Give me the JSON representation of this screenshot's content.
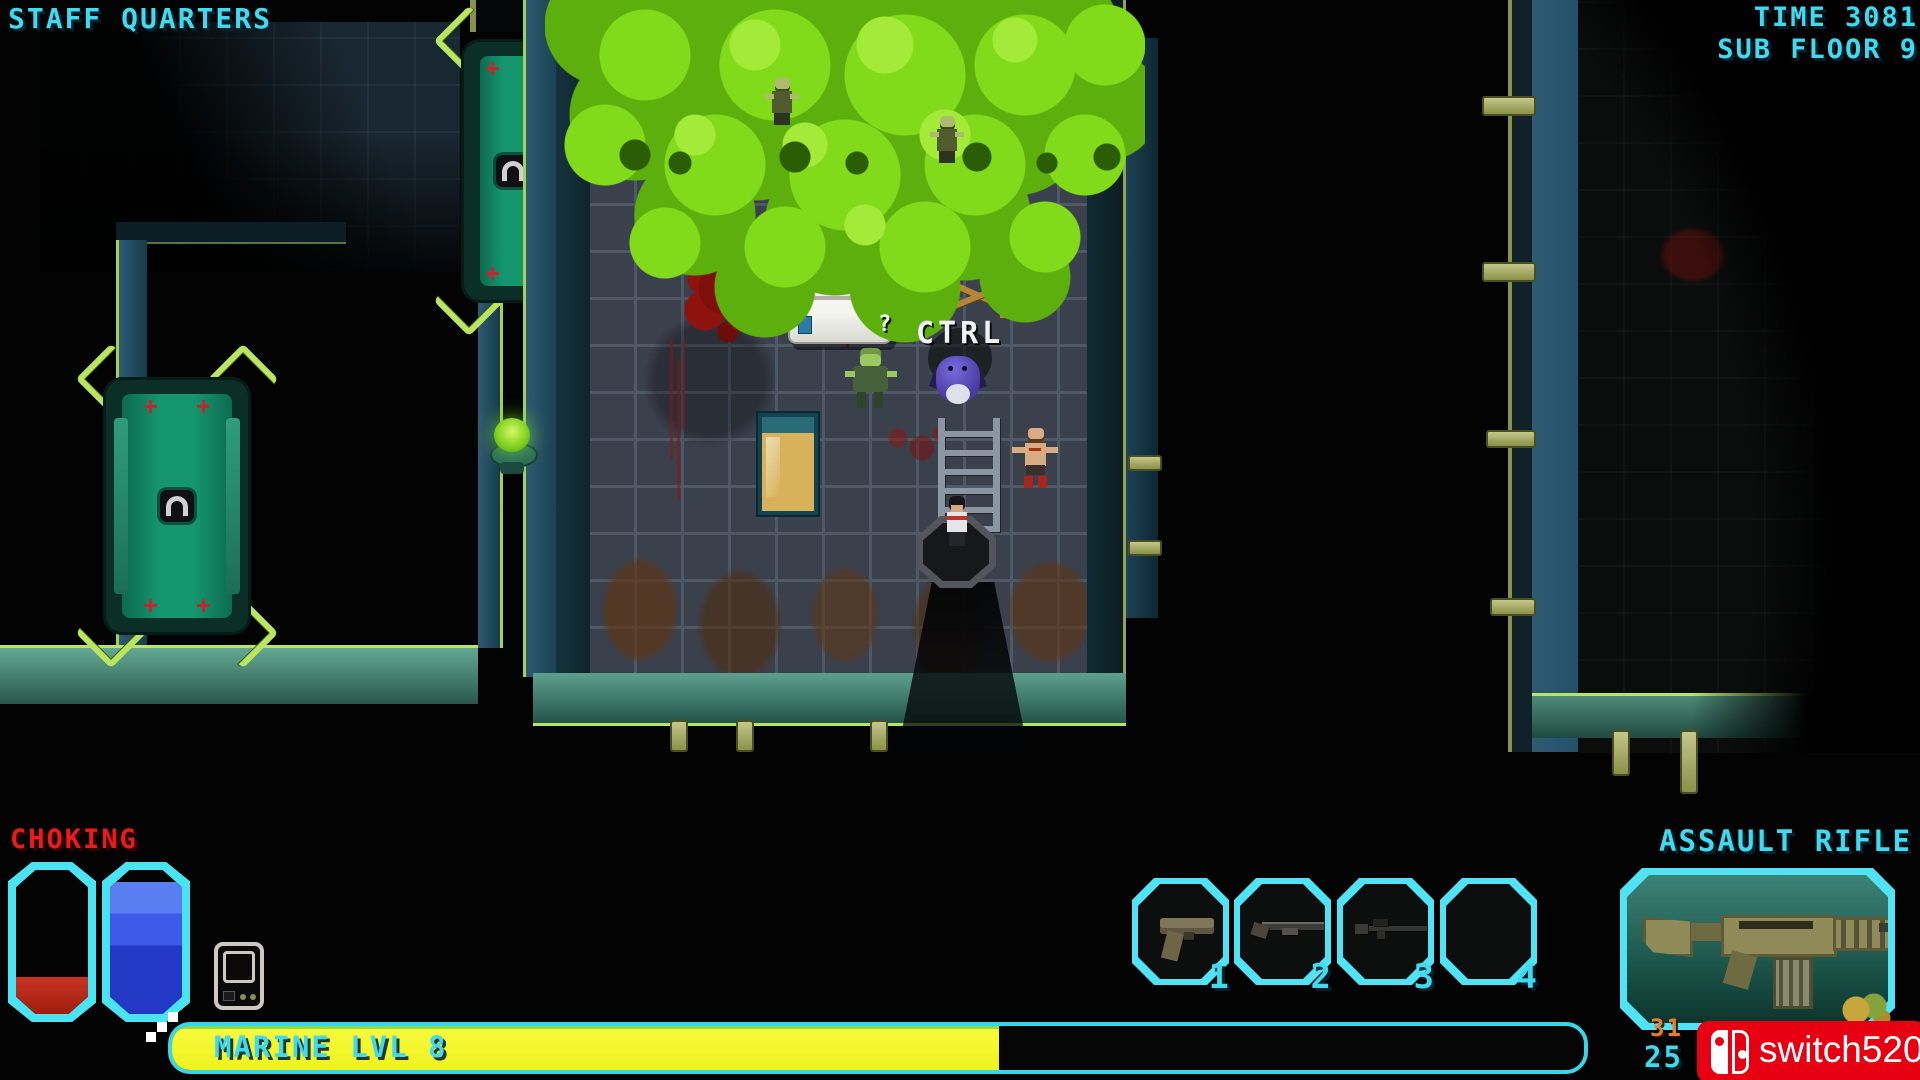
{
  "hud": {
    "top": {
      "location": "STAFF QUARTERS",
      "time": "TIME 3081",
      "floor": "SUB FLOOR 9"
    },
    "status": {
      "effect": "CHOKING"
    },
    "bars": {
      "xp_label": "MARINE LVL 8",
      "health_percent": 26,
      "energy_percent": 92,
      "xp_percent": 58.6,
      "health_fill_style": "height:26%",
      "energy_fill_style": "height:92%",
      "xp_fill_style": "width:58.6%"
    },
    "weapon": {
      "name": "ASSAULT RIFLE",
      "ammo_reserve": "31",
      "ammo_magazine": "25"
    },
    "slots": [
      {
        "number": "1",
        "weapon": "pistol"
      },
      {
        "number": "2",
        "weapon": "shotgun"
      },
      {
        "number": "3",
        "weapon": "scoped-rifle"
      },
      {
        "number": "4",
        "weapon": "empty"
      }
    ]
  },
  "world": {
    "interact_prompt": "CTRL",
    "loot_hint": "?"
  },
  "watermark": {
    "text": "switch520"
  },
  "colors": {
    "accent_cyan": "#41d9ee",
    "warning_red": "#ea1b1b",
    "xp_yellow": "#eef21e",
    "health_red": "#b32012",
    "energy_blue": "#3354e3",
    "gas_green": "#84d922",
    "wall_lime": "#b9e561",
    "door_teal": "#15966f",
    "ammo_orange": "#e08030",
    "watermark_red": "#e60012"
  }
}
